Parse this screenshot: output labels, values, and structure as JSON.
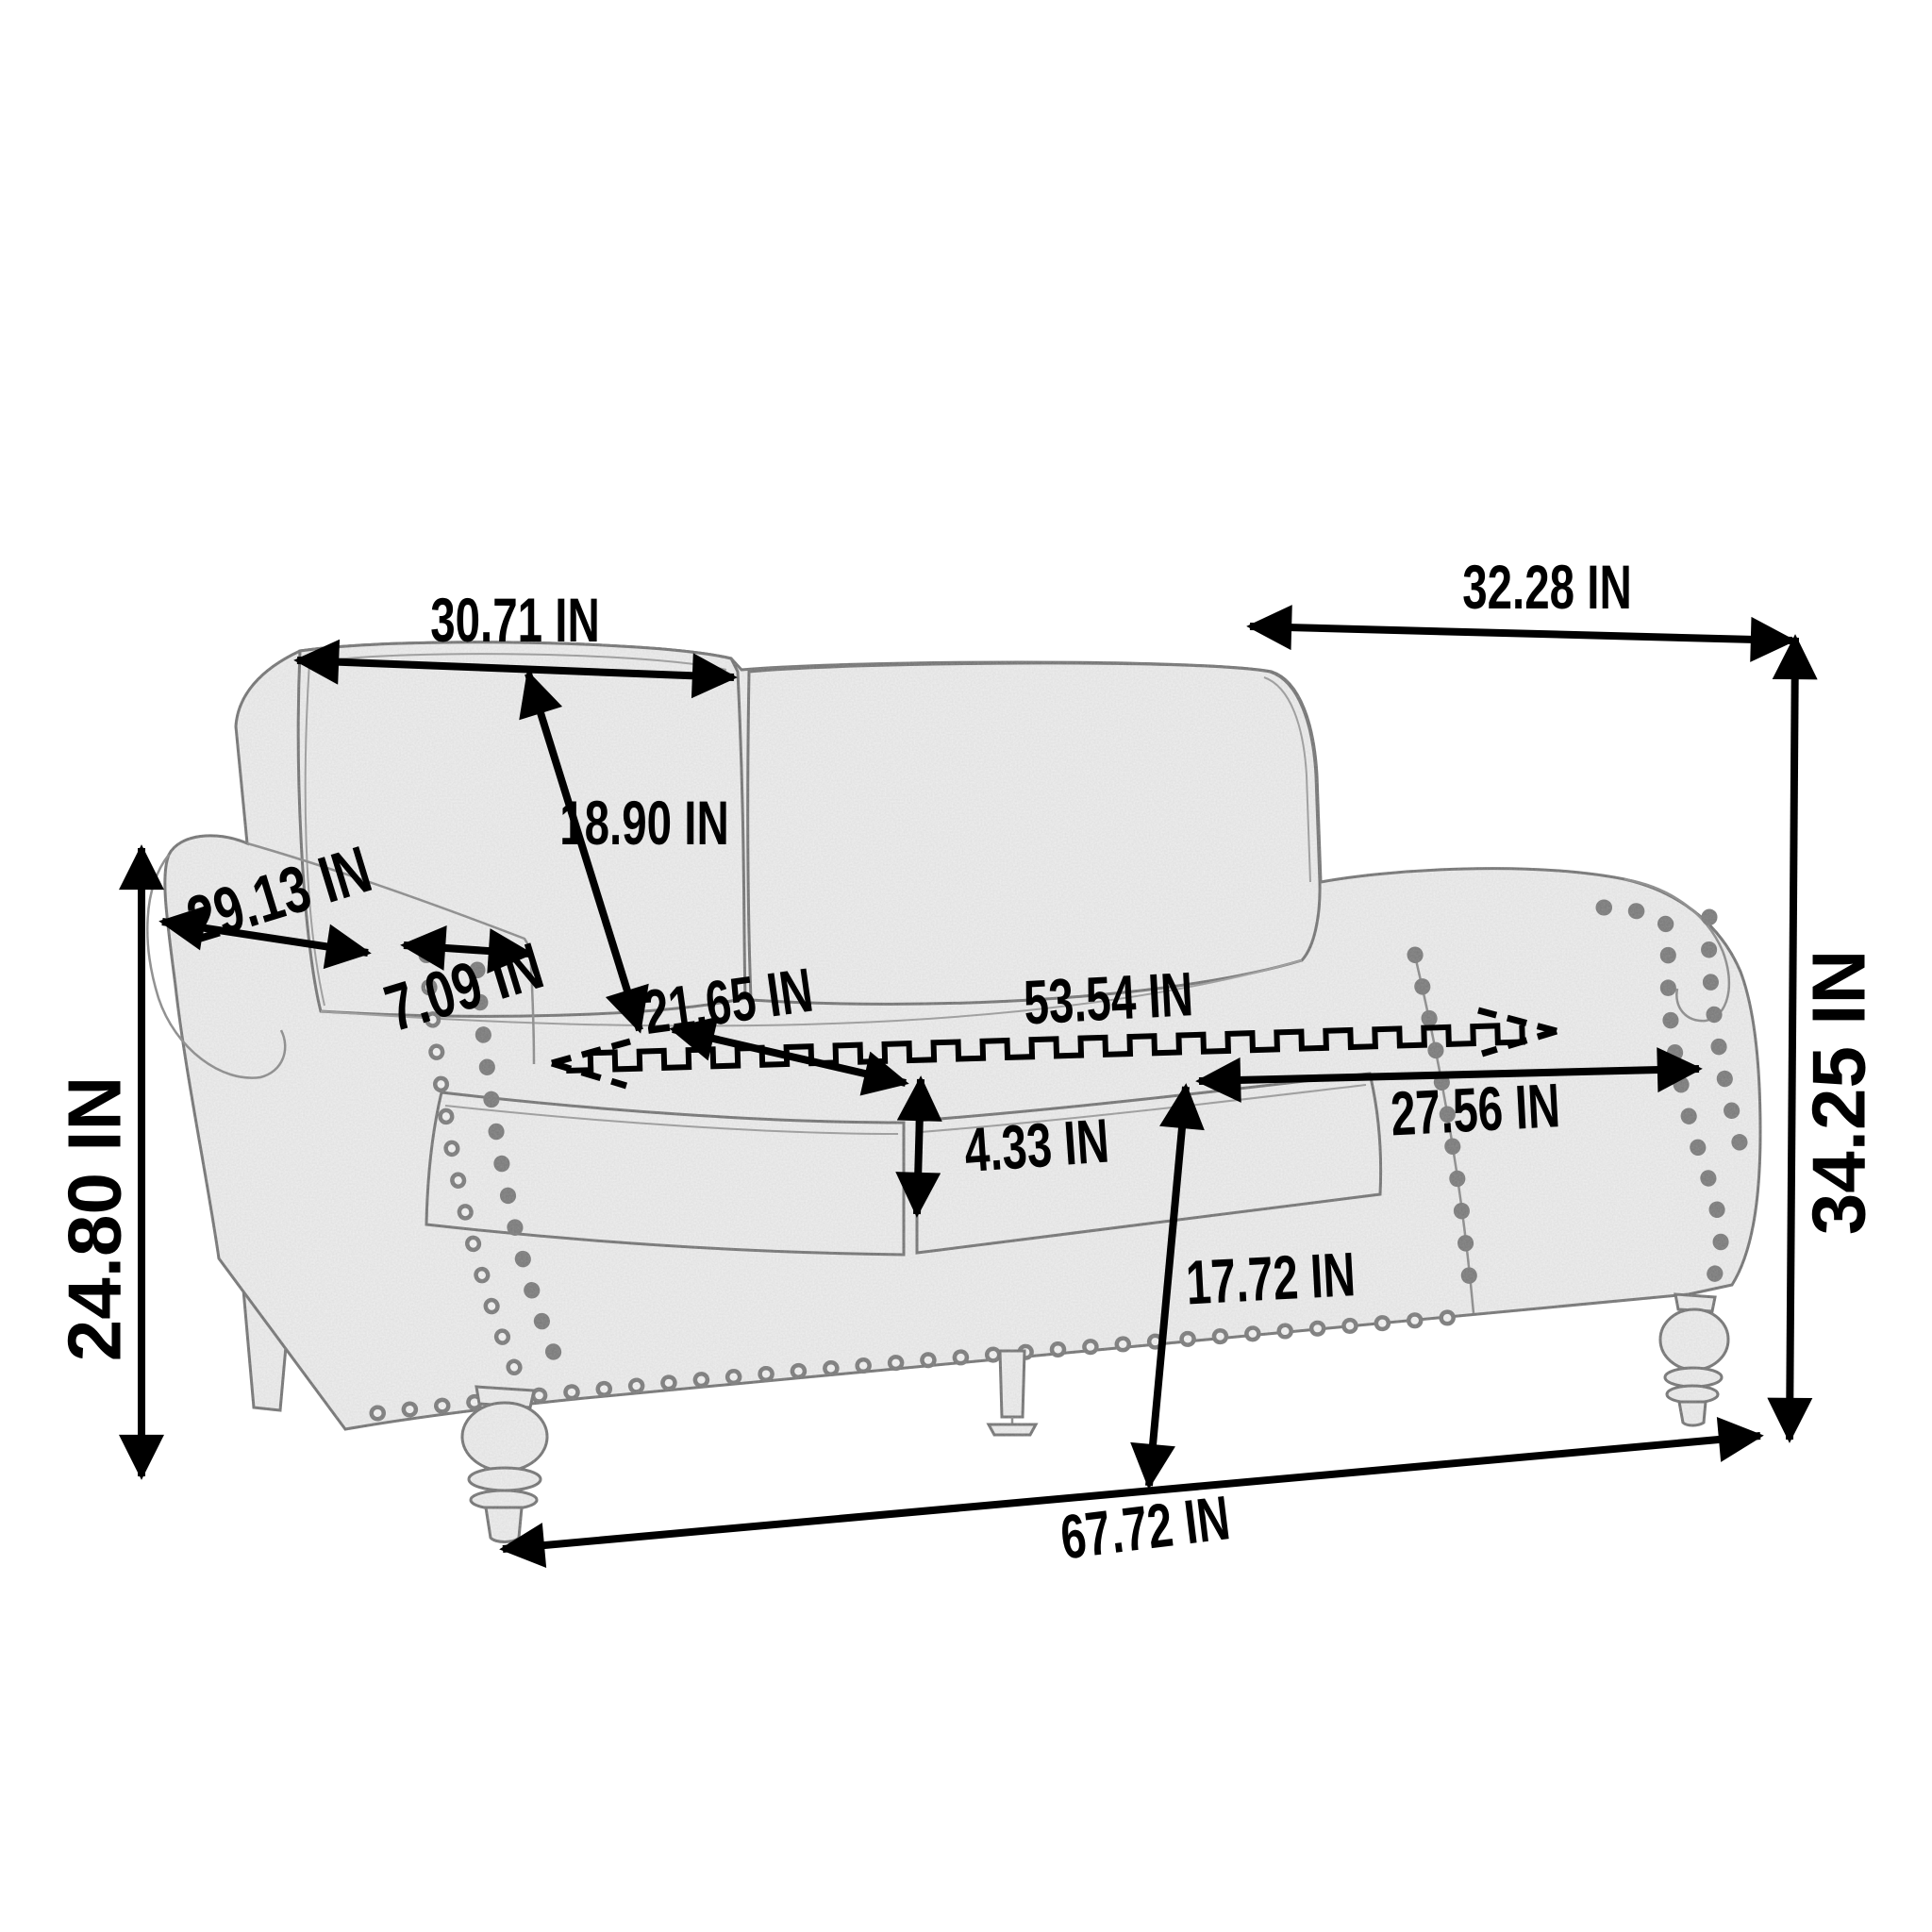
{
  "diagram": {
    "kind": "product-dimension-drawing",
    "subject": "loveseat sofa with rolled arms, nailhead trim and turned legs",
    "unit": "IN",
    "background_color": "#ffffff",
    "annotation_color": "#000000",
    "sketch_line_color": "#6f6f6f",
    "sketch_fill_color": "#efefef"
  },
  "dims": [
    {
      "id": "back-cushion-width",
      "value": 30.71,
      "label": "30.71 IN"
    },
    {
      "id": "overall-depth",
      "value": 32.28,
      "label": "32.28 IN"
    },
    {
      "id": "back-cushion-height",
      "value": 18.9,
      "label": "18.90 IN"
    },
    {
      "id": "arm-depth",
      "value": 29.13,
      "label": "29.13 IN"
    },
    {
      "id": "arm-width",
      "value": 7.09,
      "label": "7.09 IN"
    },
    {
      "id": "arm-height",
      "value": 24.8,
      "label": "24.80 IN"
    },
    {
      "id": "seat-depth",
      "value": 21.65,
      "label": "21.65 IN"
    },
    {
      "id": "seat-width-total",
      "value": 53.54,
      "label": "53.54 IN"
    },
    {
      "id": "seat-cushion-thickness",
      "value": 4.33,
      "label": "4.33 IN"
    },
    {
      "id": "seat-cushion-width",
      "value": 27.56,
      "label": "27.56 IN"
    },
    {
      "id": "seat-height",
      "value": 17.72,
      "label": "17.72 IN"
    },
    {
      "id": "overall-height",
      "value": 34.25,
      "label": "34.25 IN"
    },
    {
      "id": "overall-width",
      "value": 67.72,
      "label": "67.72 IN"
    }
  ]
}
